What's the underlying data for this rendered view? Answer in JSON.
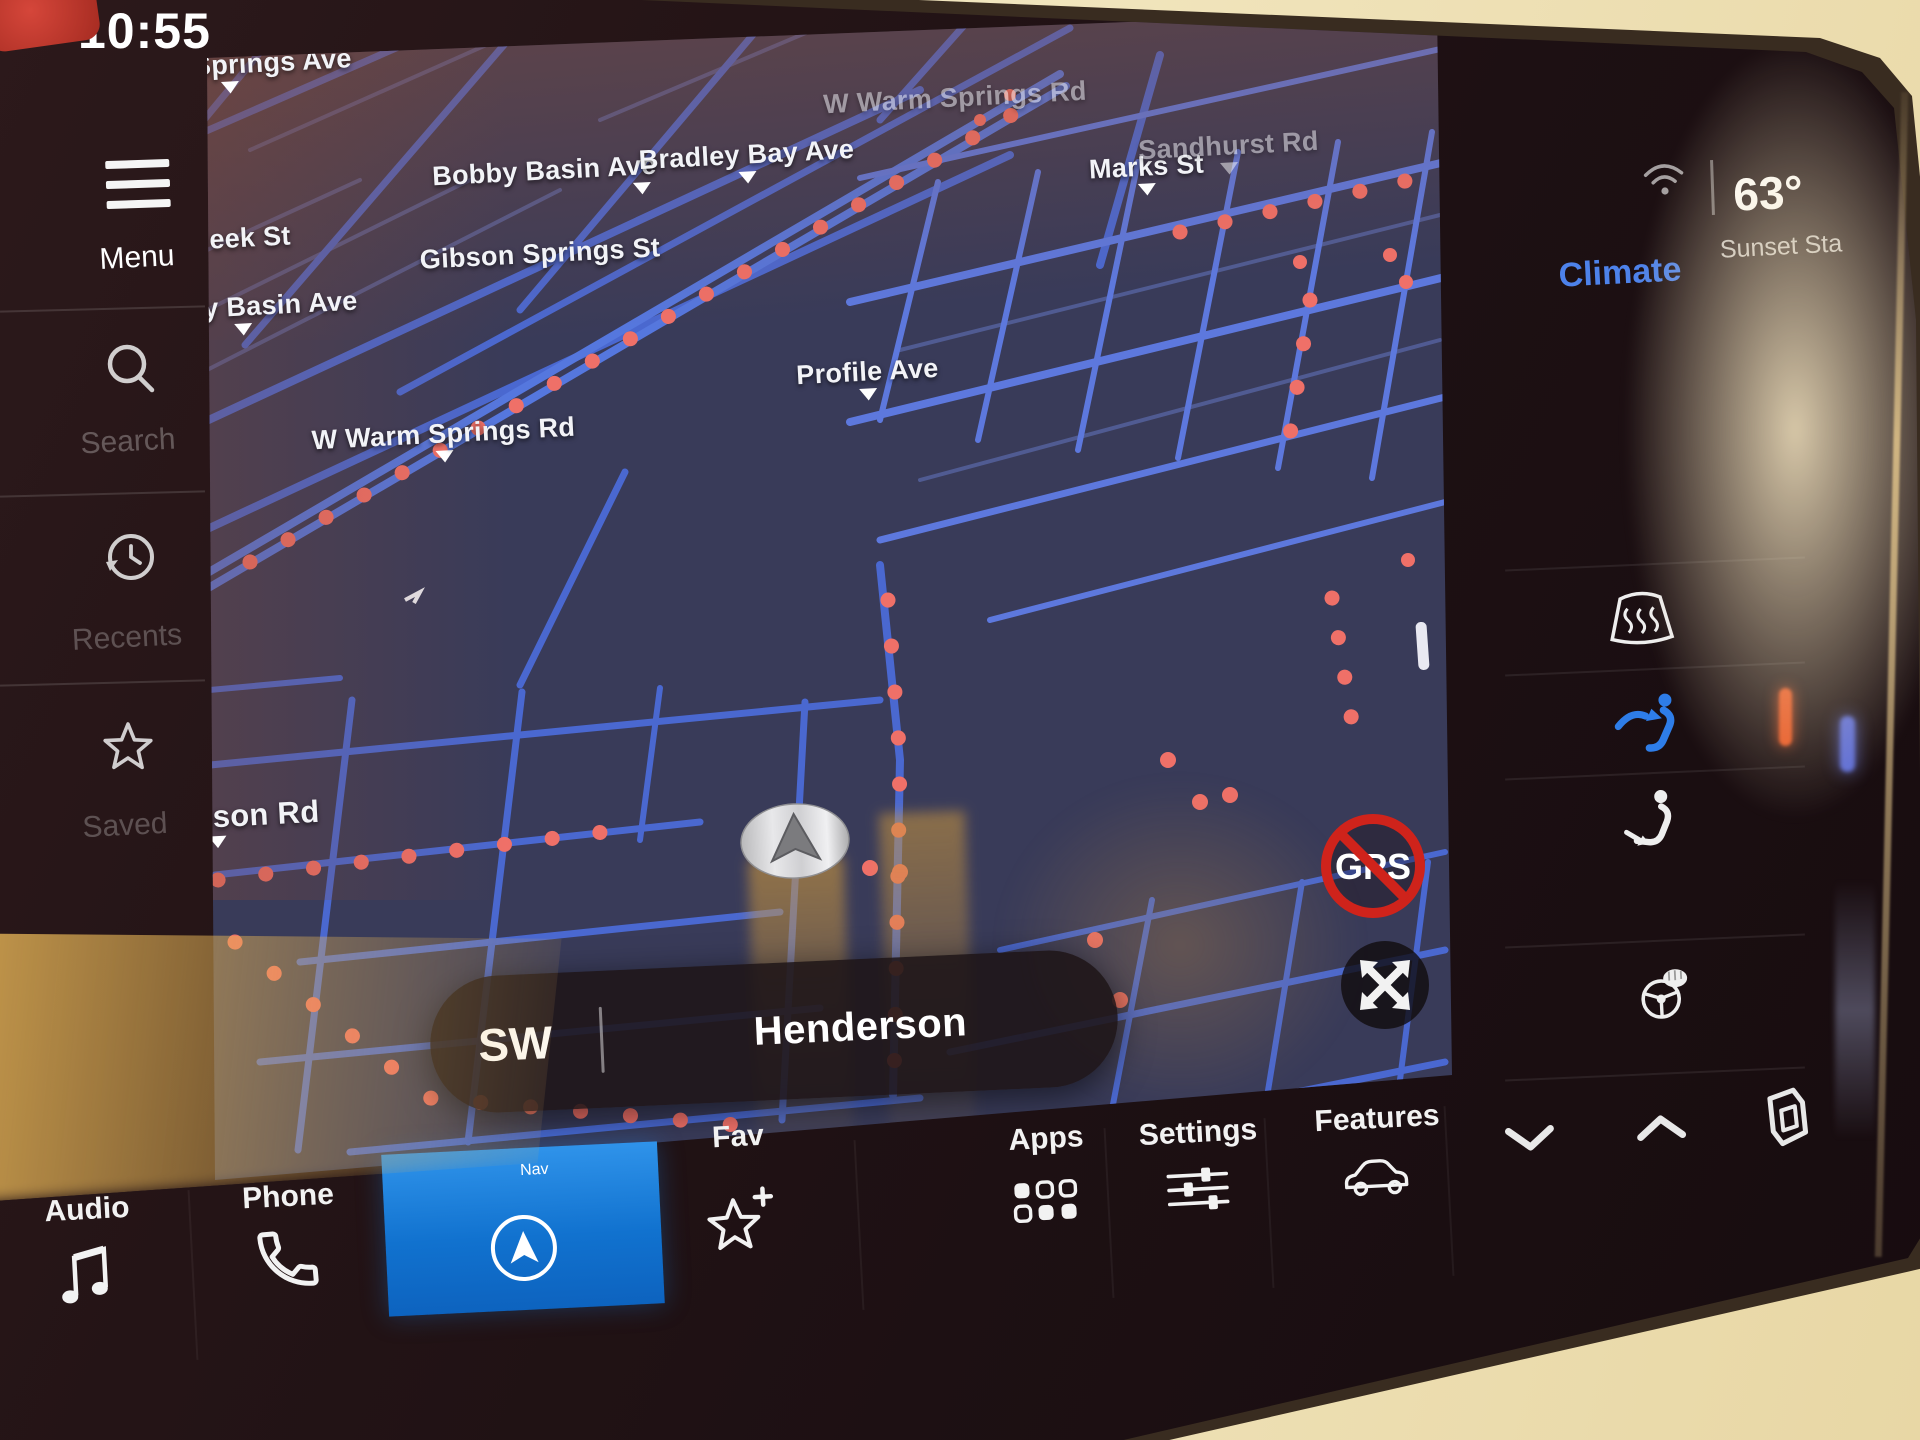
{
  "status": {
    "time": "10:55",
    "temperature": "63°",
    "station_label": "Sunset Sta",
    "climate_label": "Climate",
    "wifi_icon": "wifi-signal-icon"
  },
  "sidebar": {
    "items": [
      {
        "label": "Menu",
        "icon": "hamburger-menu-icon"
      },
      {
        "label": "Search",
        "icon": "search-icon"
      },
      {
        "label": "Recents",
        "icon": "history-clock-icon"
      },
      {
        "label": "Saved",
        "icon": "star-icon"
      }
    ]
  },
  "map": {
    "streets": [
      {
        "label": "Barby Springs Ave"
      },
      {
        "label": "Bobby Basin Ave"
      },
      {
        "label": "Bradley Bay Ave"
      },
      {
        "label": "W Warm Springs Rd"
      },
      {
        "label": "Marks St"
      },
      {
        "label": "Sandhurst Rd"
      },
      {
        "label": "eek St"
      },
      {
        "label": "Gibson Springs St"
      },
      {
        "label": "y Basin Ave"
      },
      {
        "label": "Profile Ave"
      },
      {
        "label": "W Warm Springs Rd"
      },
      {
        "label": "oson Rd"
      }
    ],
    "position_pill": {
      "direction": "SW",
      "location": "Henderson"
    },
    "gps_badge_label": "GPS",
    "vehicle_marker": "vehicle-arrow",
    "expand_icon": "expand-arrows-icon"
  },
  "dock": {
    "items": [
      {
        "label": "Audio",
        "icon": "music-note-icon"
      },
      {
        "label": "Phone",
        "icon": "phone-icon"
      },
      {
        "label": "Nav",
        "icon": "nav-compass-icon",
        "active": true
      },
      {
        "label": "Fav",
        "icon": "star-plus-icon"
      },
      {
        "label": "Apps",
        "icon": "app-grid-icon"
      },
      {
        "label": "Settings",
        "icon": "sliders-icon"
      },
      {
        "label": "Features",
        "icon": "car-icon"
      }
    ],
    "climate_shortcuts": [
      "chevron-down-icon",
      "chevron-up-icon",
      "layers-icon"
    ]
  },
  "climate_panel": {
    "icons": [
      "defrost-windshield-icon",
      "vent-face-icon",
      "vent-feet-icon",
      "heated-steering-wheel-icon"
    ]
  },
  "colors": {
    "nav_active": "#1a7bd4",
    "climate_text": "#4d82ea",
    "map_bg": "#393b59",
    "road_blue": "#4a68d0",
    "traffic_dot": "#ef7068",
    "gps_red": "#cf231b",
    "bezel_beige": "#efe3bd"
  }
}
